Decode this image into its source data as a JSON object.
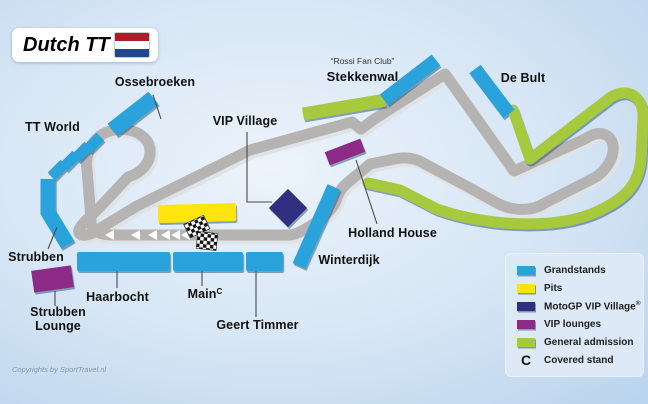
{
  "title": {
    "text": "Dutch TT"
  },
  "labels": {
    "ossebroeken": "Ossebroeken",
    "tt_world": "TT World",
    "vip_village": "VIP Village",
    "rossi_fan_club": "“Rossi Fan Club”",
    "stekkenwal": "Stekkenwal",
    "de_bult": "De Bult",
    "holland_house": "Holland House",
    "winterdijk": "Winterdijk",
    "strubben": "Strubben",
    "strubben_lounge_line1": "Strubben",
    "strubben_lounge_line2": "Lounge",
    "haarbocht": "Haarbocht",
    "main": "Main",
    "main_superscript": "C",
    "geert_timmer": "Geert Timmer"
  },
  "legend": {
    "items": [
      {
        "label": "Grandstands",
        "color": "#29A3DC"
      },
      {
        "label": "Pits",
        "color": "#FFE408"
      },
      {
        "label": "MotoGP VIP Village",
        "suffix": "®",
        "color": "#312E80"
      },
      {
        "label": "VIP lounges",
        "color": "#8C2B86"
      },
      {
        "label": "General admission",
        "color": "#A6C93C"
      },
      {
        "symbol": "C",
        "label": "Covered stand"
      }
    ]
  },
  "footer": {
    "copyright": "Copyrights by SportTravel.nl"
  },
  "colors": {
    "grandstand": "#29A3DC",
    "pits": "#FFE408",
    "vip-village": "#312E80",
    "vip-lounge": "#8C2B86",
    "general-admission": "#A6C93C",
    "track": "#B5B4B3",
    "flag-red": "#AE1C28",
    "flag-white": "#FFFFFF",
    "flag-blue": "#21468B"
  }
}
